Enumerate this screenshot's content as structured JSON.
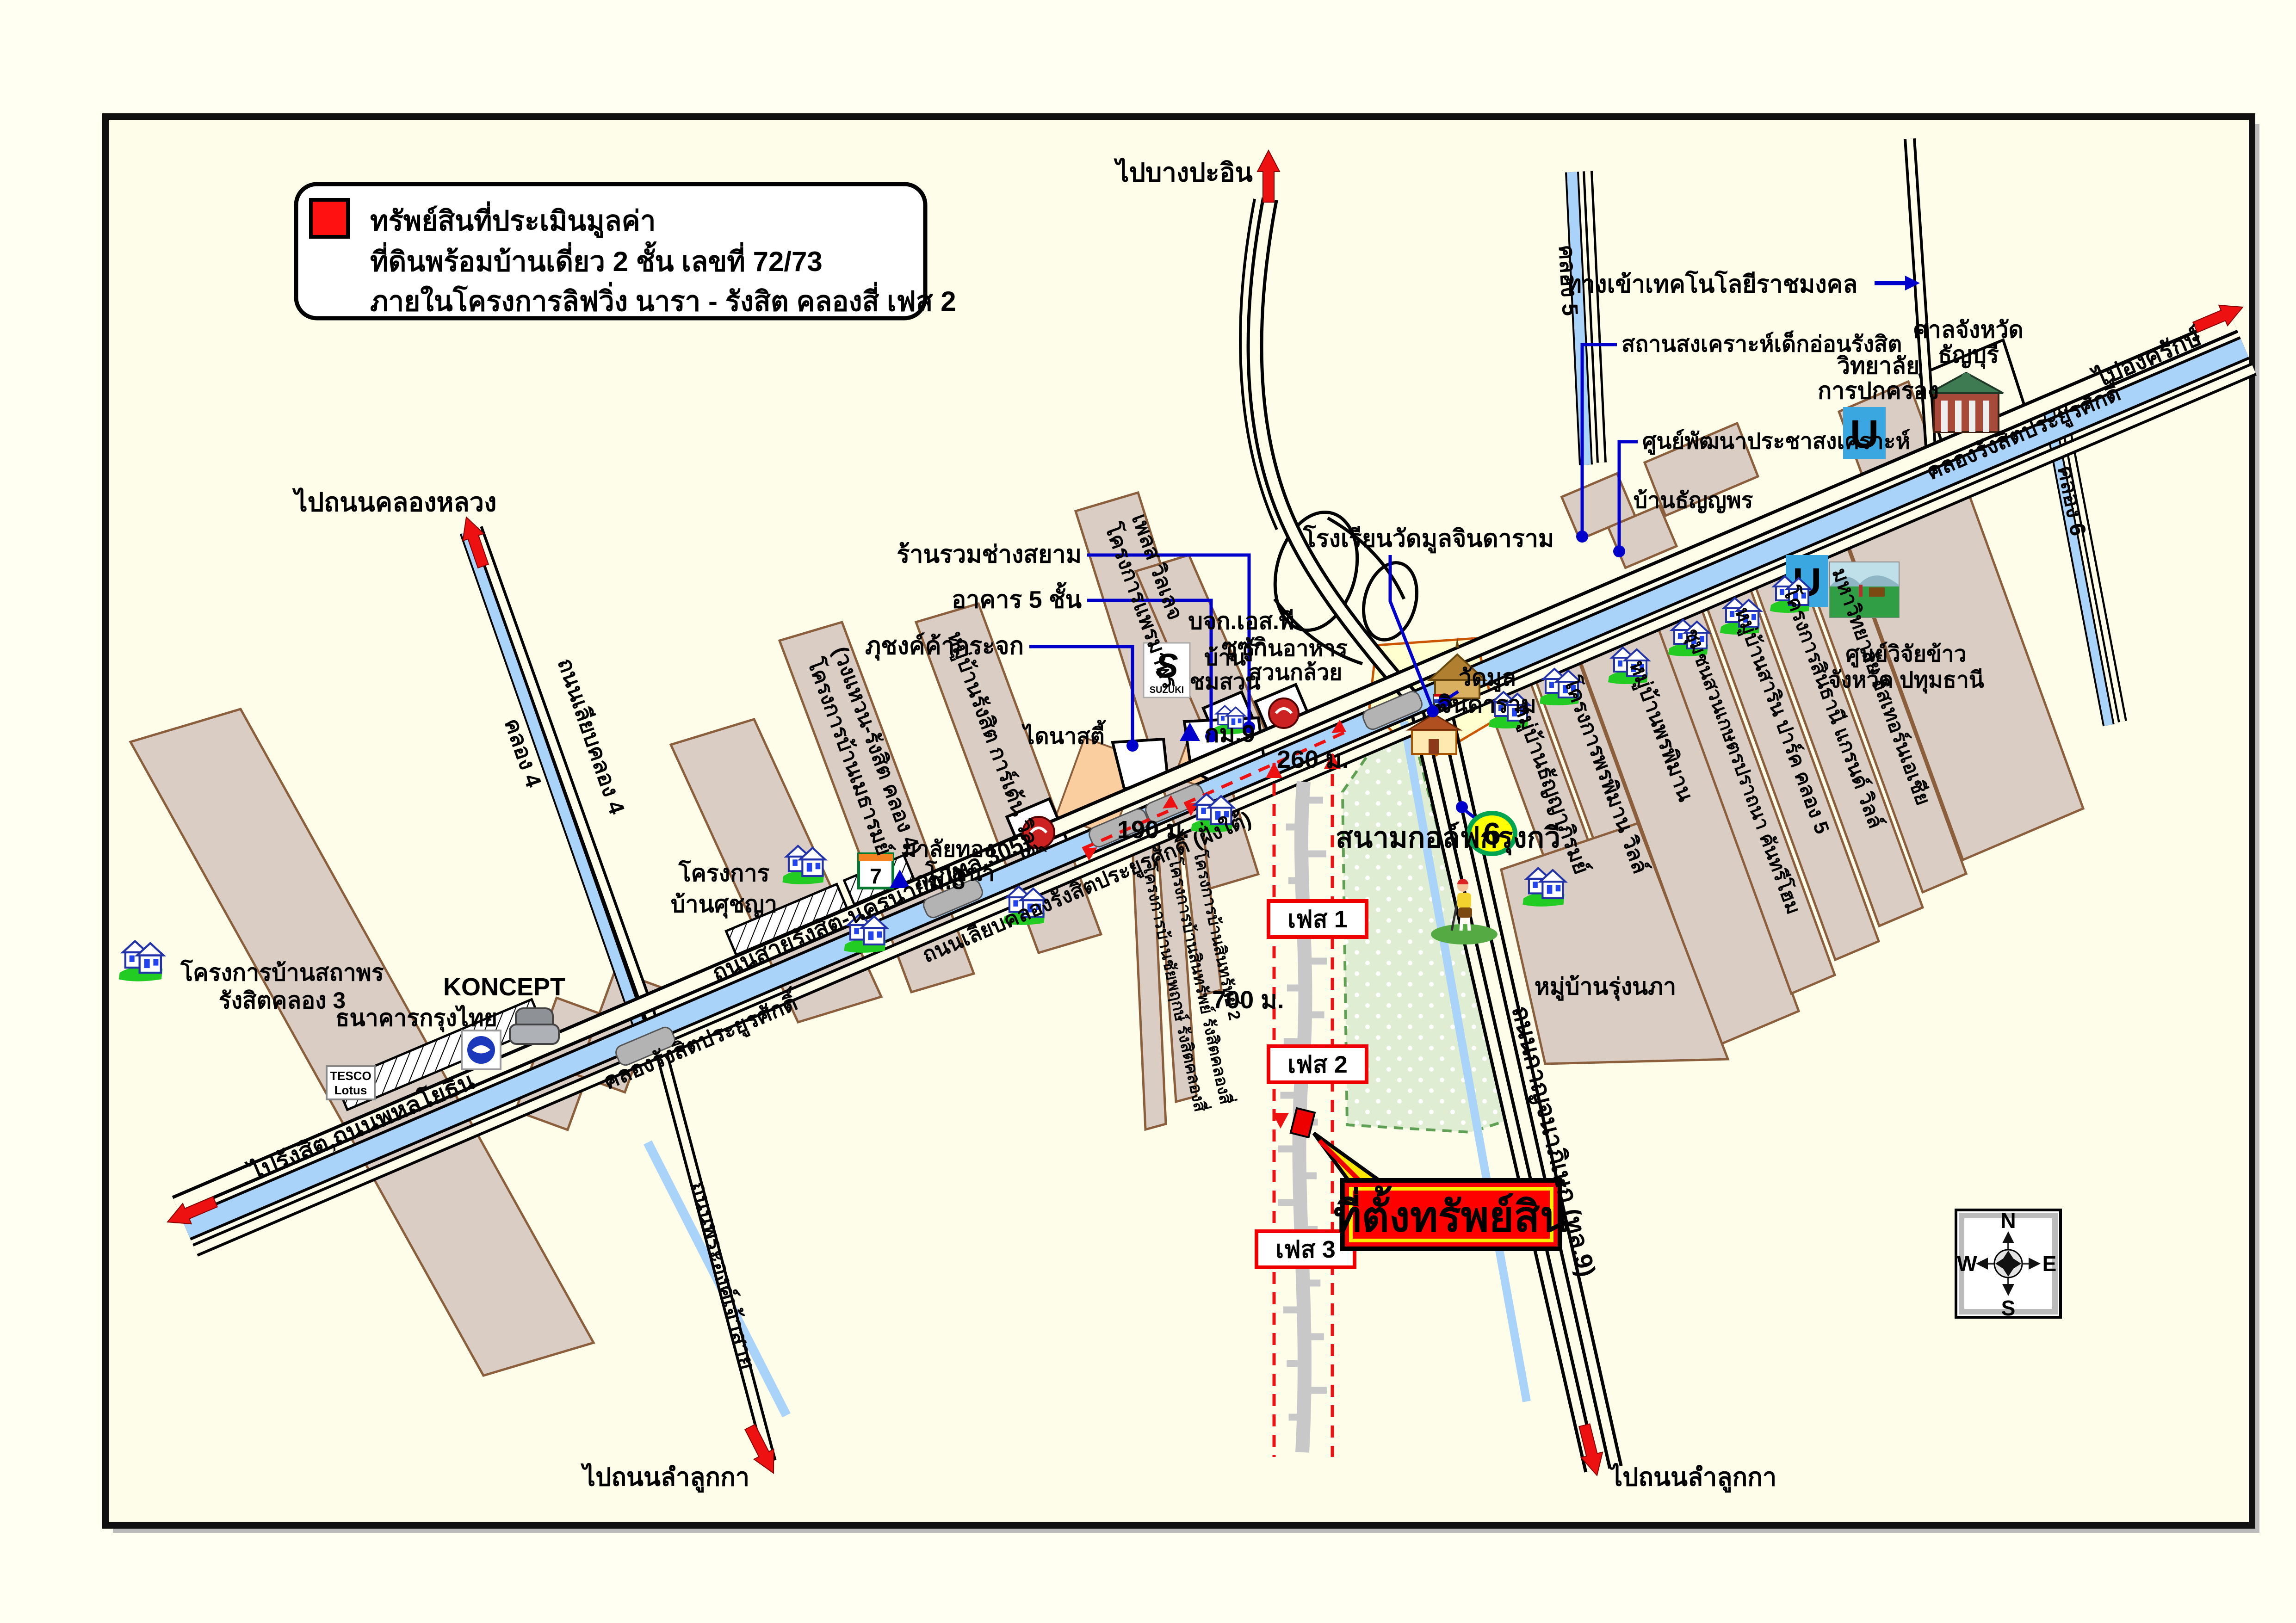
{
  "legend": {
    "title": "ทรัพย์สินที่ประเมินมูลค่า",
    "line2": "ที่ดินพร้อมบ้านเดี่ยว 2 ชั้น เลขที่ 72/73",
    "line3": "ภายในโครงการลิฟวิ่ง นารา - รังสิต คลองสี่ เฟส 2"
  },
  "arrows": {
    "bang_pa_in": "ไปบางปะอิน",
    "khlong_luang": "ไปถนนคลองหลวง",
    "rangsit_phahonyothin": "ไปรังสิต,ถนนพหลโยธิน",
    "ong_kharak": "ไปองครักษ์",
    "lam_luk_ka_left": "ไปถนนลำลูกกา",
    "lam_luk_ka_right": "ไปถนนลำลูกกา"
  },
  "roads": {
    "r305": "ถนนสายรังสิต-นครนายก (ทล.305)",
    "service": "ถนนเลียบคลองรังสิตประยูรศักดิ์ (ฝั่งใต้)",
    "kanchana": "ถนนกาญจนาภิเษก (ทล.9)",
    "phra_ong": "ถนนพระองค์เจ้าสาย",
    "liab_k4": "ถนนเลียบคลอง 4",
    "techno": "ทางเข้าเทคโนโลยีราชมงคล"
  },
  "canals": {
    "rangsit_left": "คลองรังสิตประยูรศักดิ์",
    "rangsit_right": "คลองรังสิตประยูรศักดิ์",
    "k4": "คลอง 4",
    "k5": "คลอง 5",
    "k6": "คลอง 6"
  },
  "places": {
    "infant_home": "สถานสงเคราะห์เด็กอ่อนรังสิต",
    "community_dev": "ศูนย์พัฒนาประชาสงเคราะห์",
    "college_admin1": "วิทยาลัย",
    "college_admin2": "การปกครอง",
    "court1": "ศาลจังหวัด",
    "court2": "ธัญบุรี",
    "ban_thanyaporn": "บ้านธัญญพร",
    "school_watmun": "โรงเรียนวัดมูลจินดาราม",
    "watmun1": "วัดมูล",
    "watmun2": "จินดาราม",
    "golf": "สนามกอล์ฟกรุงกวี",
    "siam_shop": "ร้านรวมช่างสยาม",
    "building5": "อาคาร 5 ชั้น",
    "glass": "ภุชงค์ค้ากระจก",
    "suzuki1": "บจก.เอส.พี.",
    "suzuki2": "ซูซูกิ",
    "chomsuan1": "บ้าน",
    "chomsuan2": "ชมสวน",
    "banana1": "ร้านอาหาร",
    "banana2": "สวนกล้วย",
    "malaithong1": "มาลัยทอง",
    "malaithong2": "โภชนา",
    "dynasty": "ไดนาสตี้",
    "ktb": "ธนาคารกรุงไทย",
    "koncept": "KONCEPT",
    "rice1": "ศูนย์วิจัยข้าว",
    "rice2": "จังหวัด ปทุมธานี"
  },
  "projects": {
    "sathaporn1": "โครงการบ้านสถาพร",
    "sathaporn2": "รังสิตคลอง 3",
    "suchaya1": "โครงการ",
    "suchaya2": "บ้านศุชญา",
    "metharom1": "โครงการบ้านเมธารมย์",
    "metharom2": "(วงแหวน-รังสิต คลอง 4)",
    "garden": "หมู่บ้านรังสิต การ์เด้น วิลล์",
    "phraemaporn1": "โครงการแพรมาพร",
    "phraemaporn2": "เพลส วิลเลจ",
    "chaiyapruek": "โครงการบ้านชัยพฤกษ์ รังสิตคลองสี่",
    "sinsap1": "โครงการบ้านสินทรัพย์ รังสิตคลองสี่",
    "sinsap2": "โครงการบ้านสินทรัพย์ 2",
    "thanyapirom": "หมู่บ้านธัญญาภิรมย์",
    "pornpiman_ville": "โครงการพรพิมาน วิลล์",
    "pornpiman": "หมู่บ้านพรพิมาน",
    "kaset": "ชุมชนสวนเกษตรปราถนา คันทรีโฮม",
    "sarin": "หมู่บ้านสาริน ปาร์ค คลอง 5",
    "sinthani": "โครงการสินธานี แกรนด์ วิลล์",
    "eastern": "มหาวิทยาลัย อีสเทอร์นเอเชีย",
    "rungnapha": "หมู่บ้านรุ่งนภา"
  },
  "markers": {
    "km8": "กม.8",
    "km9": "กม.9",
    "route6": "6",
    "phase1": "เฟส 1",
    "phase2": "เฟส 2",
    "phase3": "เฟส 3",
    "d190": "190 ม.",
    "d260": "260 ม.",
    "d700": "700 ม.",
    "property": "ที่ตั้งทรัพย์สิน"
  },
  "compass": {
    "n": "N",
    "e": "E",
    "s": "S",
    "w": "W"
  },
  "logos": {
    "u1": "U",
    "u2": "U",
    "suzuki": "SUZUKI",
    "seven": "7",
    "tesco": "TESCO",
    "lotus": "Lotus"
  },
  "colors": {
    "property_red": "#FF0000",
    "canal_blue": "#A9D3F8",
    "parcel_tan": "#D9CDC4",
    "golf_green": "#DFEDD3",
    "leader_blue": "#0000CC",
    "map_bg": "#FDFDE9"
  }
}
